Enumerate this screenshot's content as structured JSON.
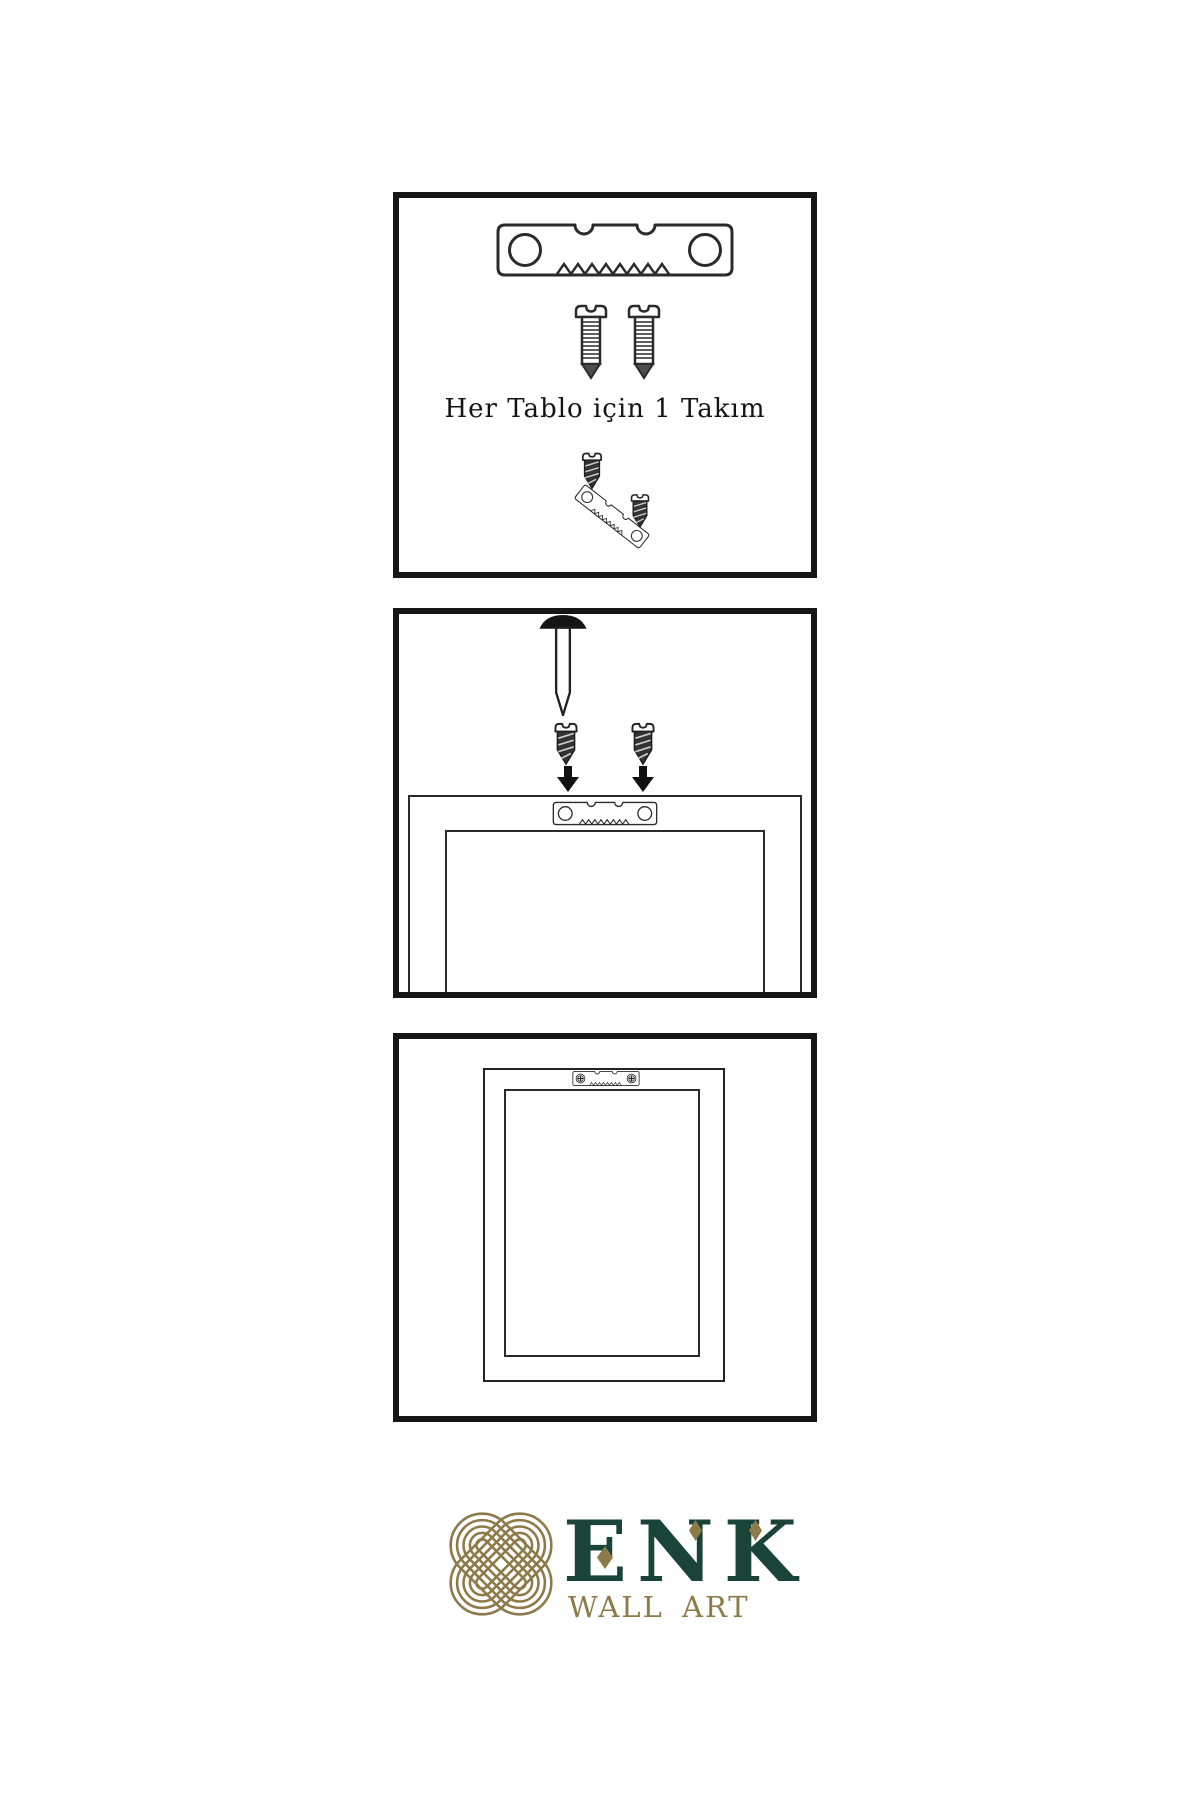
{
  "sheet": {
    "type": "wall-art hanging instruction sheet",
    "background": "#ffffff",
    "line_color": "#2b2b2b",
    "panel_border_color": "#161616"
  },
  "steps": [
    {
      "caption": "Her Tablo için 1 Takım",
      "items": [
        "sawtooth-hanger",
        "screw",
        "screw",
        "screw",
        "angled-sawtooth-hanger",
        "screw"
      ]
    },
    {
      "items": [
        "wall-nail",
        "screw",
        "screw",
        "down-arrow",
        "down-arrow",
        "frame-back",
        "sawtooth-hanger"
      ]
    },
    {
      "items": [
        "frame-front",
        "mounted-sawtooth-hanger-with-screws"
      ]
    }
  ],
  "brand": {
    "name": "ENK",
    "tagline": "WALL ART",
    "colors": {
      "green": "#1b4438",
      "gold": "#8d7a49"
    }
  }
}
